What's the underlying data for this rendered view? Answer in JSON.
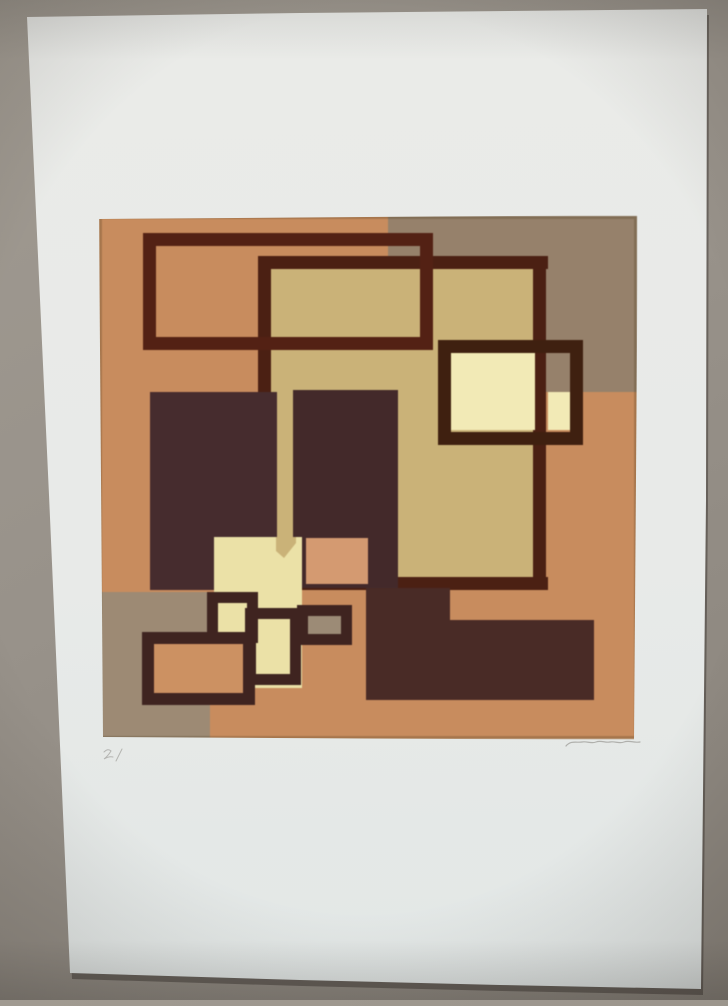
{
  "photo": {
    "background_color": "#98928a",
    "vignette_color": "#231e19"
  },
  "paper": {
    "color": "#e8eae8",
    "shadow_color": "#32302b",
    "inscriptions": [
      {
        "name": "edition-mark-pencil",
        "d": "M104,752 q4,-4 7,-1 q-3,5 -7,8 q5,-3 9,-2 m3,4 l6,-12",
        "stroke": "#a09e9a",
        "sw": 1,
        "opacity": 0.7
      },
      {
        "name": "artist-signature-pencil",
        "d": "M566,746 C571,740 577,743 582,742 C587,741 591,744 596,742 C601,740 605,743 610,742 C615,741 619,744 624,742 C629,740 634,743 640,742",
        "stroke": "#a3a19d",
        "sw": 1.2,
        "opacity": 0.8
      }
    ]
  },
  "artwork": {
    "canvas_color": "#ca8c5c",
    "palette": {
      "orange": "#ca8c5c",
      "taupe": "#97816a",
      "khaki": "#cbb276",
      "pale_cream": "#f2eab4",
      "cream": "#ebe1a5",
      "salmon": "#d59a6f",
      "dark_maroon": "#44292a",
      "dark_brown_line": "#4c2012"
    },
    "shapes": [
      {
        "name": "canvas-base",
        "x": 99,
        "y": 216,
        "w": 538,
        "h": 523,
        "fill": "#ca8c5c"
      },
      {
        "name": "taupe-block-top-right",
        "x": 388,
        "y": 216,
        "w": 249,
        "h": 176,
        "fill": "#97816a"
      },
      {
        "name": "khaki-field",
        "x": 265,
        "y": 262,
        "w": 272,
        "h": 320,
        "fill": "#cbb276"
      },
      {
        "name": "frame-b-top",
        "x": 258,
        "y": 256,
        "w": 290,
        "h": 13,
        "fill": "#4c2012"
      },
      {
        "name": "frame-b-left",
        "x": 258,
        "y": 256,
        "w": 13,
        "h": 334,
        "fill": "#4c2012"
      },
      {
        "name": "frame-b-bottom",
        "x": 258,
        "y": 577,
        "w": 290,
        "h": 13,
        "fill": "#4c2012"
      },
      {
        "name": "frame-b-right",
        "x": 533,
        "y": 256,
        "w": 13,
        "h": 334,
        "fill": "#4c2012"
      },
      {
        "name": "frame-a",
        "x": 149.5,
        "y": 239.5,
        "w": 277,
        "h": 104,
        "fill": "none",
        "stroke": "#542113",
        "sw": 13
      },
      {
        "name": "dark-block-left",
        "x": 150,
        "y": 392,
        "w": 127,
        "h": 198,
        "fill": "#472c2e"
      },
      {
        "name": "dark-block-center",
        "x": 293,
        "y": 390,
        "w": 105,
        "h": 198,
        "fill": "#44292a"
      },
      {
        "name": "dark-strip-vertical",
        "x": 366,
        "y": 556,
        "w": 32,
        "h": 144,
        "fill": "#44292a"
      },
      {
        "name": "dark-block-bottom",
        "x": 366,
        "y": 588,
        "w": 84,
        "h": 112,
        "fill": "#4a2b26"
      },
      {
        "name": "dark-bar-bottom-right",
        "x": 366,
        "y": 620,
        "w": 228,
        "h": 80,
        "fill": "#4a2b26"
      },
      {
        "name": "pale-square-main",
        "x": 451,
        "y": 353,
        "w": 84,
        "h": 77,
        "fill": "#f2eab4"
      },
      {
        "name": "pale-square-small",
        "x": 548,
        "y": 392,
        "w": 24,
        "h": 38,
        "fill": "#f2eab4"
      },
      {
        "name": "frame-e",
        "x": 444.5,
        "y": 346.5,
        "w": 132,
        "h": 92,
        "fill": "none",
        "stroke": "#40200f",
        "sw": 13
      },
      {
        "name": "salmon-square",
        "x": 306,
        "y": 538,
        "w": 62,
        "h": 46,
        "fill": "#d59a6f"
      },
      {
        "name": "cream-block",
        "x": 214,
        "y": 537,
        "w": 88,
        "h": 151,
        "fill": "#ebe1a5"
      },
      {
        "name": "khaki-tab",
        "points": "276,537 296,537 296,543 284,558 276,551",
        "fill": "#cbb276"
      },
      {
        "name": "taupe-block-bottom-left",
        "x": 100,
        "y": 592,
        "w": 110,
        "h": 146,
        "fill": "#9d8a73"
      },
      {
        "name": "frame-f-orange",
        "x": 148,
        "y": 638,
        "w": 101,
        "h": 61,
        "fill": "#ce9160",
        "stroke": "#402420",
        "sw": 12
      },
      {
        "name": "frame-g-upper",
        "x": 212.5,
        "y": 597.5,
        "w": 40,
        "h": 40,
        "fill": "none",
        "stroke": "#402420",
        "sw": 11
      },
      {
        "name": "frame-g-lower",
        "x": 250.5,
        "y": 613.5,
        "w": 45,
        "h": 66,
        "fill": "none",
        "stroke": "#402420",
        "sw": 11
      },
      {
        "name": "frame-h-taupe",
        "x": 302.5,
        "y": 610.5,
        "w": 44,
        "h": 29,
        "fill": "#9c8b75",
        "stroke": "#402420",
        "sw": 11
      },
      {
        "name": "canvas-edge",
        "x": 100.5,
        "y": 217.5,
        "w": 535,
        "h": 520,
        "fill": "none",
        "stroke": "rgba(80,60,30,0.28)",
        "sw": 3
      }
    ]
  }
}
